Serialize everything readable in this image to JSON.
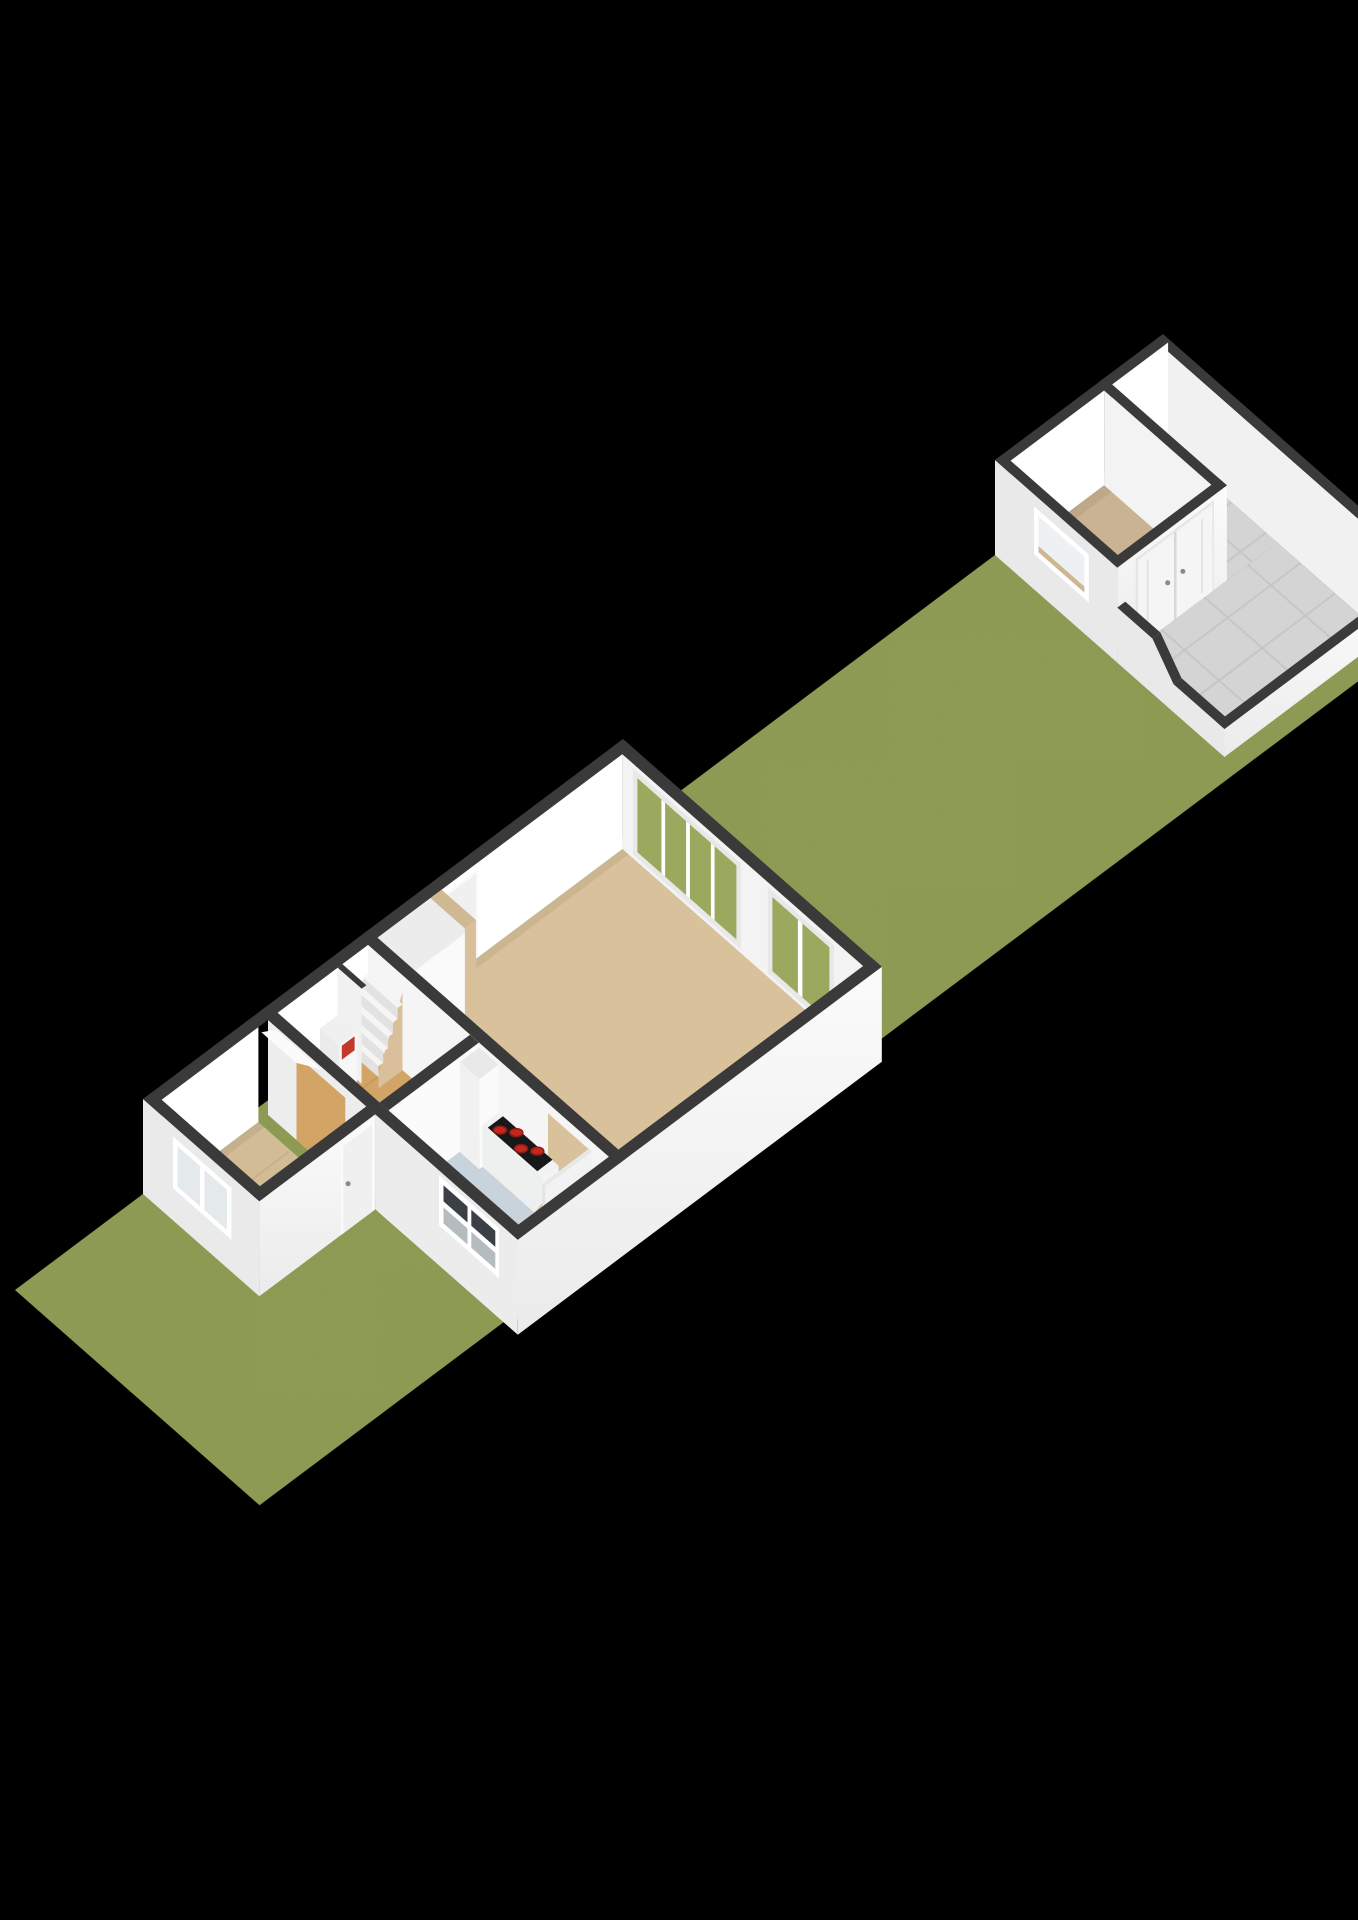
{
  "scene": {
    "kind": "floorplan-3d-render",
    "view": "isometric-birdseye",
    "background": "#000000",
    "structures": [
      "garden-strip",
      "main-house-ground-floor",
      "detached-shed-with-patio"
    ]
  },
  "colors": {
    "background": "#000000",
    "grass": "#8e9d52",
    "grassNoise": "#3f491c",
    "wallTop": "#3a3a3a",
    "wallInner": "#ffffff",
    "wallInnerSW": "#f3f3f3",
    "wallExtSE": "#f7f7f7",
    "wallExtSEdark": "#ececec",
    "wallExtSW": "#e9e9e9",
    "floorLiving": "#d9c19b",
    "floorHall": "#d2a566",
    "floorHallLine": "#c49a5f",
    "floorWing": "#d2bc96",
    "floorWingLine": "#c8b188",
    "floorShed": "#c9b392",
    "floorKitchen": "#c9d3dc",
    "tile": "#d4d4d4",
    "tileLine": "#c6c6c6",
    "glassGreen": "#9aa95e",
    "glassDark": "#3a4045",
    "glassPale": "#b4bcc0",
    "glassLight": "#e4e9ec",
    "windowFrame": "#ffffff",
    "hob": "#17181a",
    "burner": "#c2281e",
    "burnerRing": "#8e1a12",
    "doorLeaf": "#f0f0f0",
    "doorFrame": "#fafafa",
    "handle": "#8a8a8a",
    "meterRed": "#c0392b",
    "stairSide": "#d9c09b",
    "stairTread": "#f5f5f5",
    "stairRiser": "#e2e2e2",
    "sink": "#c6cacc",
    "sinkEdge": "#a9adaf",
    "shadow": "rgba(0,0,0,0.06)"
  }
}
